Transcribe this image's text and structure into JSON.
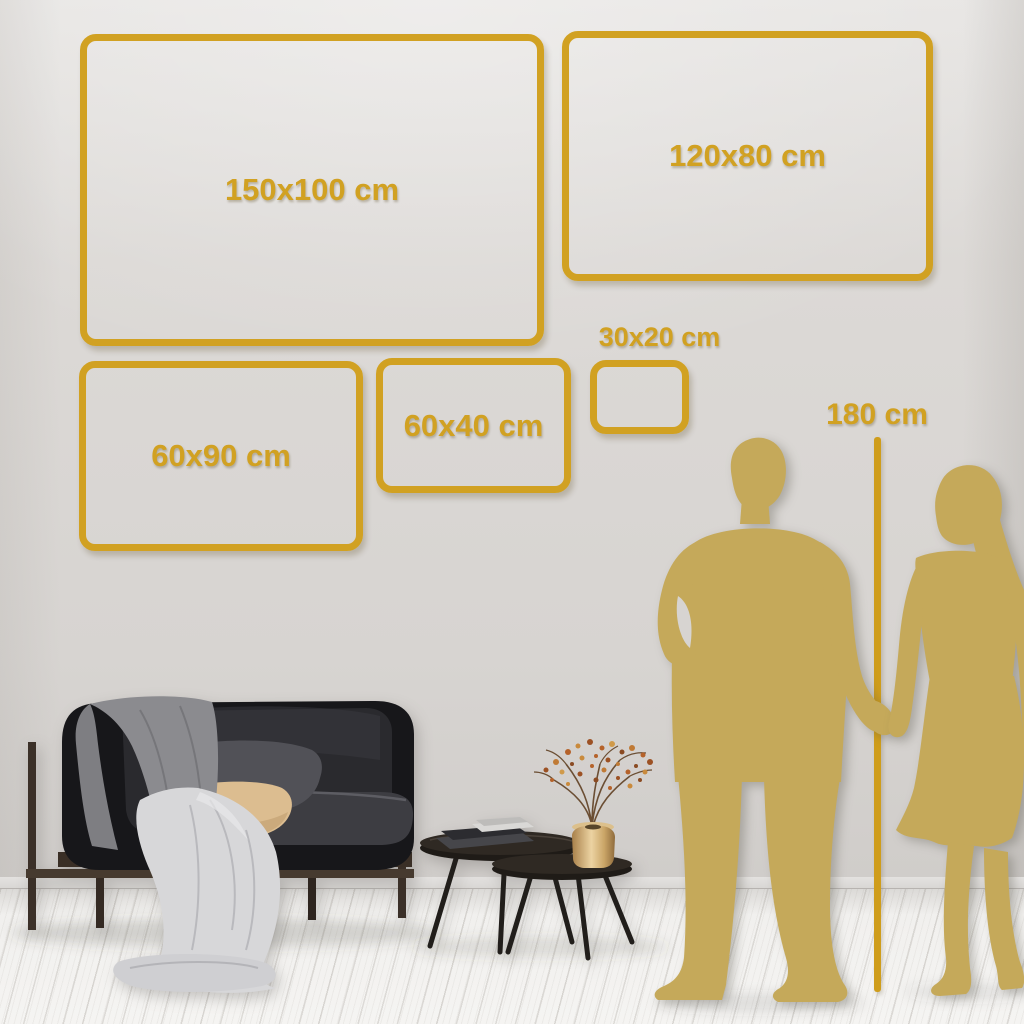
{
  "size_guide": {
    "sizes": [
      {
        "label": "150x100 cm"
      },
      {
        "label": "120x80 cm"
      },
      {
        "label": "60x90 cm"
      },
      {
        "label": "60x40 cm"
      },
      {
        "label": "30x20 cm"
      }
    ],
    "height_reference": {
      "label": "180 cm"
    }
  },
  "colors": {
    "frame_gold": "#d1a122",
    "ruler_gold": "#cf9d1b",
    "silhouette_gold": "#c5a95a",
    "wall": "#d9d6d3",
    "floor": "#f2f1ef",
    "sofa_black": "#17171a",
    "wood_brown": "#3a2f26",
    "tan_pillow": "#dcbd90",
    "brass_vase": "#caa567"
  }
}
